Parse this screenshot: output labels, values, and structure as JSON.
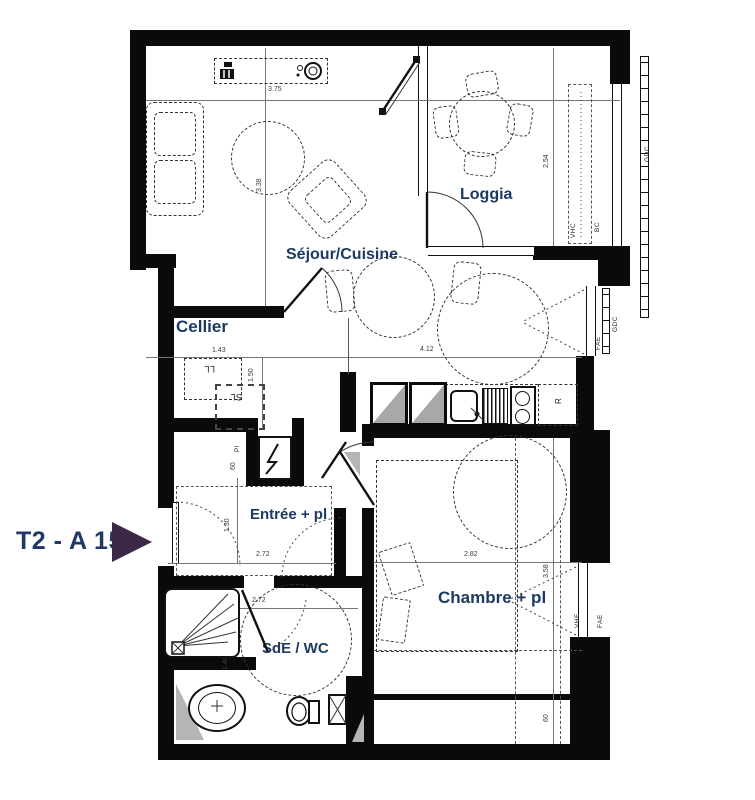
{
  "plan": {
    "title": "T2 - A 15",
    "rooms": {
      "sejour": "Séjour/Cuisine",
      "loggia": "Loggia",
      "cellier": "Cellier",
      "entree": "Entrée + pl",
      "chambre": "Chambre + pl",
      "sde": "SdE / WC"
    },
    "dims": {
      "sejour_top": "3.75",
      "sejour_left": "3.38",
      "loggia_right": "2.54",
      "cellier_w": "1.43",
      "cellier_h": "1.50",
      "sejour_mid": "4.12",
      "entree_w": "2.72",
      "entree_h": "1.30",
      "sde_w": "2.72",
      "sde_h": "1.48",
      "chambre_w": "2.82",
      "chambre_h": "3.58",
      "closet_depth": "60",
      "niche_depth": "60"
    },
    "codes": {
      "washer": "LL",
      "dryer": "SL",
      "fridge": "R",
      "closet": "Pl",
      "duct_loggia": "VHC",
      "bc": "BC",
      "railing_top": "GDC",
      "railing_mid": "GDC",
      "window_mid": "FAE",
      "window_chambre": "FAE",
      "duct_chambre": "VHE"
    },
    "colors": {
      "label": "#1d3a63",
      "title": "#1f3864",
      "arrow": "#3d2746",
      "wall": "#0a0a0a"
    }
  }
}
